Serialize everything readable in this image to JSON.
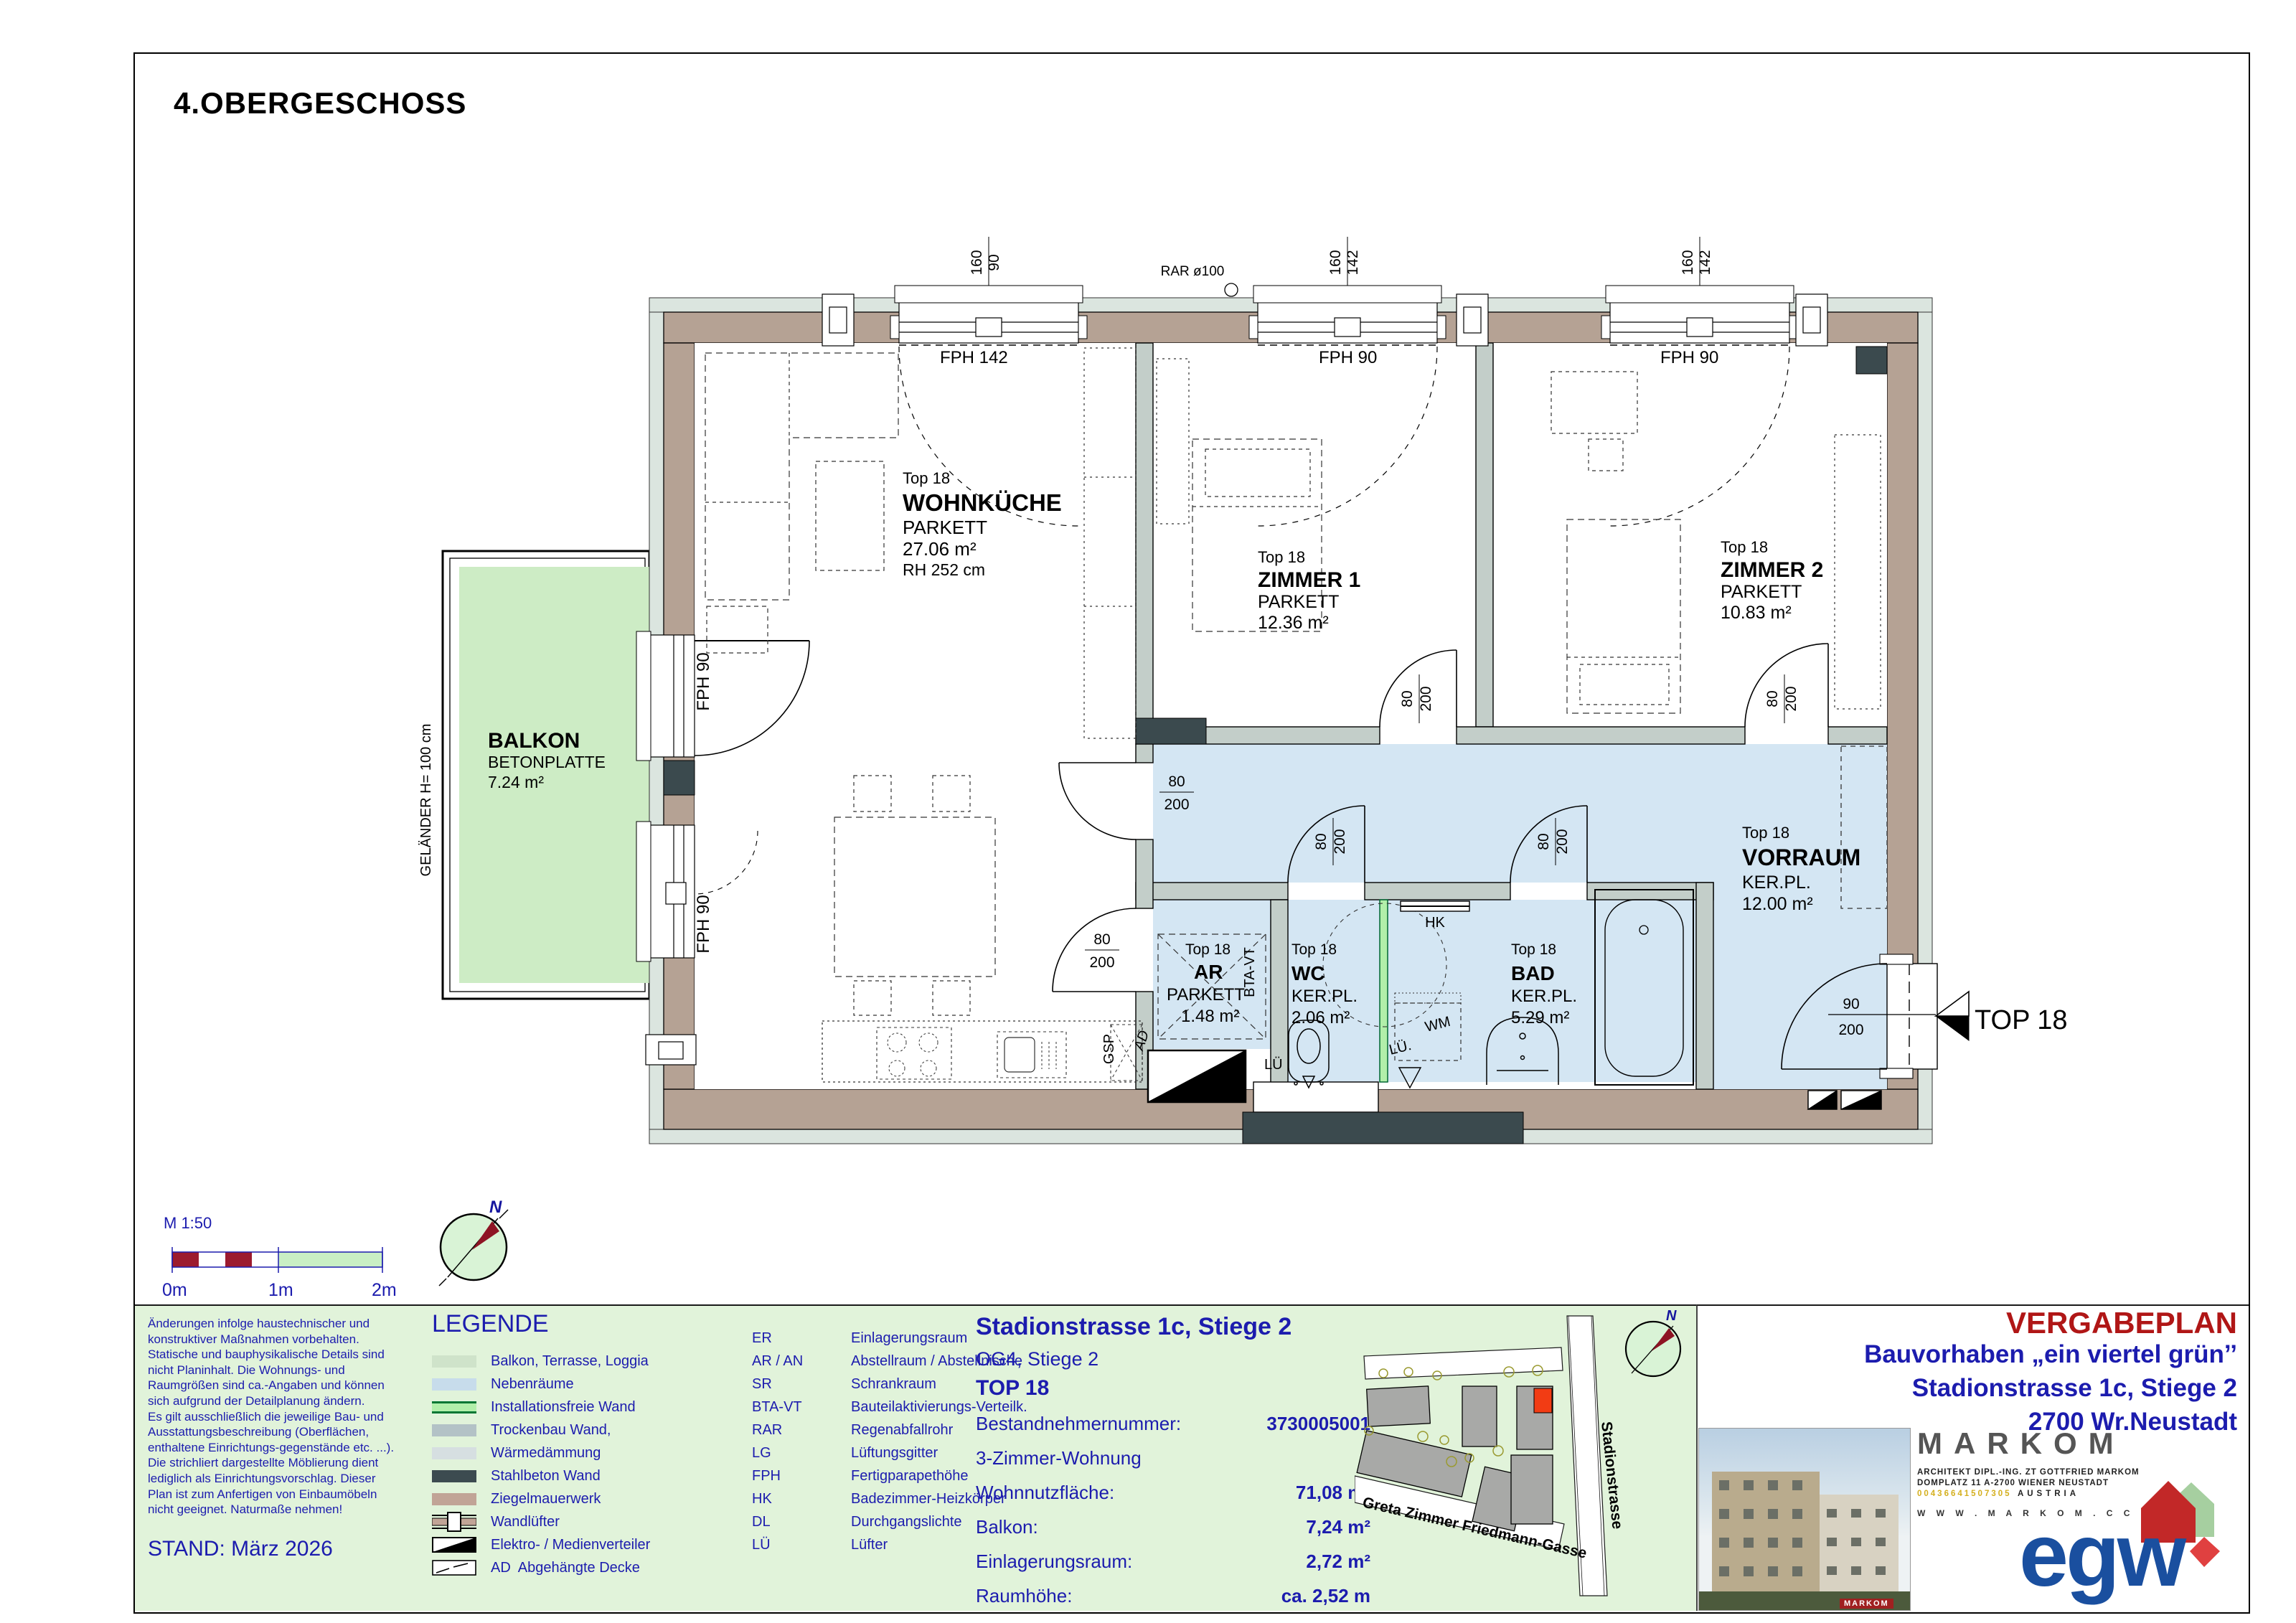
{
  "sheet": {
    "title": "4.OBERGESCHOSS"
  },
  "plan": {
    "compass_n": "N",
    "rooms": {
      "wohnkueche": {
        "top": "Top 18",
        "name": "WOHNKÜCHE",
        "floor": "PARKETT",
        "area": "27.06 m²",
        "rh": "RH 252 cm"
      },
      "zimmer1": {
        "top": "Top 18",
        "name": "ZIMMER 1",
        "floor": "PARKETT",
        "area": "12.36 m²"
      },
      "zimmer2": {
        "top": "Top 18",
        "name": "ZIMMER 2",
        "floor": "PARKETT",
        "area": "10.83 m²"
      },
      "vorraum": {
        "top": "Top 18",
        "name": "VORRAUM",
        "floor": "KER.PL.",
        "area": "12.00 m²"
      },
      "ar": {
        "top": "Top 18",
        "name": "AR",
        "floor": "PARKETT",
        "area": "1.48 m²"
      },
      "wc": {
        "top": "Top 18",
        "name": "WC",
        "floor": "KER.PL.",
        "area": "2.06 m²"
      },
      "bad": {
        "top": "Top 18",
        "name": "BAD",
        "floor": "KER.PL.",
        "area": "5.29 m²"
      },
      "balkon": {
        "name": "BALKON",
        "sub": "BETONPLATTE",
        "area": "7.24 m²",
        "railing": "GELÄNDER H= 100 cm"
      }
    },
    "labels": {
      "fph142": "FPH 142",
      "fph90": "FPH 90",
      "rar": "RAR ø100",
      "gsp": "GSP",
      "hk": "HK",
      "wm": "WM",
      "lue": "LÜ",
      "lue2": "LÜ.",
      "btavt": "BTA-VT",
      "ad": "AD",
      "entrance": "TOP 18"
    },
    "dims": {
      "w160": "160",
      "w90": "90",
      "w142": "142",
      "d80": "80",
      "d200": "200",
      "d90": "90"
    }
  },
  "scalebar": {
    "label": "M 1:50",
    "t0": "0m",
    "t1": "1m",
    "t2": "2m"
  },
  "disclaimer": {
    "lines": [
      "Änderungen infolge haustechnischer und",
      "konstruktiver Maßnahmen vorbehalten.",
      "Statische und bauphysikalische Details sind",
      "nicht Planinhalt. Die Wohnungs- und",
      "Raumgrößen sind ca.-Angaben und können",
      "sich aufgrund der Detailplanung ändern.",
      "Es gilt ausschließlich die jeweilige Bau- und",
      "Ausstattungsbeschreibung (Oberflächen,",
      "enthaltene Einrichtungs-gegenstände etc. ...).",
      "Die strichliert dargestellte Möblierung dient",
      "lediglich als Einrichtungsvorschlag. Dieser",
      "Plan ist zum Anfertigen von Einbaumöbeln",
      "nicht geeignet. Naturmaße nehmen!"
    ],
    "stand": "STAND: März 2026"
  },
  "legend": {
    "title": "LEGENDE",
    "items": [
      {
        "label": "Balkon, Terrasse, Loggia"
      },
      {
        "label": "Nebenräume"
      },
      {
        "label": "Installationsfreie Wand"
      },
      {
        "label": "Trockenbau Wand,"
      },
      {
        "label": "Wärmedämmung"
      },
      {
        "label": "Stahlbeton Wand"
      },
      {
        "label": "Ziegelmauerwerk"
      },
      {
        "label": "Wandlüfter"
      },
      {
        "label": "Elektro- / Medienverteiler"
      },
      {
        "label": "Abgehängte Decke",
        "prefix": "AD"
      }
    ],
    "abbreviations": [
      {
        "code": "ER",
        "label": "Einlagerungsraum"
      },
      {
        "code": "AR / AN",
        "label": "Abstellraum / Abstellnische"
      },
      {
        "code": "SR",
        "label": "Schrankraum"
      },
      {
        "code": "BTA-VT",
        "label": "Bauteilaktivierungs-Verteilk."
      },
      {
        "code": "RAR",
        "label": "Regenabfallrohr"
      },
      {
        "code": "LG",
        "label": "Lüftungsgitter"
      },
      {
        "code": "FPH",
        "label": "Fertigparapethöhe"
      },
      {
        "code": "HK",
        "label": "Badezimmer-Heizkörper"
      },
      {
        "code": "DL",
        "label": "Durchgangslichte"
      },
      {
        "code": "LÜ",
        "label": "Lüfter"
      }
    ]
  },
  "info": {
    "title": "Stadionstrasse 1c, Stiege 2",
    "sub": "OG4, Stiege 2",
    "top": "TOP 18",
    "rows": [
      {
        "label": "Bestandnehmernummer:",
        "value": "3730005001"
      },
      {
        "label": "3-Zimmer-Wohnung",
        "value": ""
      },
      {
        "label": "Wohnnutzfläche:",
        "value": "71,08 m²"
      },
      {
        "label": "Balkon:",
        "value": "7,24 m²"
      },
      {
        "label": "Einlagerungsraum:",
        "value": "2,72 m²"
      },
      {
        "label": "Raumhöhe:",
        "value": "ca. 2,52 m"
      }
    ]
  },
  "siteplan": {
    "street1": "Greta Zimmer Friedmann-Gasse",
    "street2": "Stadionstrasse",
    "north": "N"
  },
  "titleblock": {
    "plan_type": "VERGABEPLAN",
    "project": "Bauvorhaben „ein viertel grün’’",
    "address": "Stadionstrasse 1c, Stiege 2",
    "city": "2700 Wr.Neustadt"
  },
  "markom": {
    "name": "MARKOM",
    "line1": "ARCHITEKT DIPL.-ING. ZT GOTTFRIED MARKOM",
    "line2": "DOMPLATZ 11   A-2700 WIENER NEUSTADT",
    "phone": "00436641507305",
    "country": "AUSTRIA",
    "web": "W W W . M A R K O M . C C"
  },
  "egw": {
    "logo": "egw"
  },
  "colors": {
    "wall_brick": "#b5a294",
    "wall_drywall": "#c3cec9",
    "wall_concrete": "#3b4a4e",
    "insulation": "#dbe5df",
    "rooms_secondary_blue": "#d4e6f3",
    "balcony_green": "#cdecc5",
    "installation_free_wall": "#b2efaa",
    "footer_green": "#e1f3da",
    "text_blue": "#1c1cae",
    "plan_type_red": "#b01616",
    "scalebar_red": "#9c1b2e",
    "site_building_gray": "#a8a9a7",
    "site_highlight_red": "#f23c14",
    "egw_blue": "#1a4f9f"
  }
}
